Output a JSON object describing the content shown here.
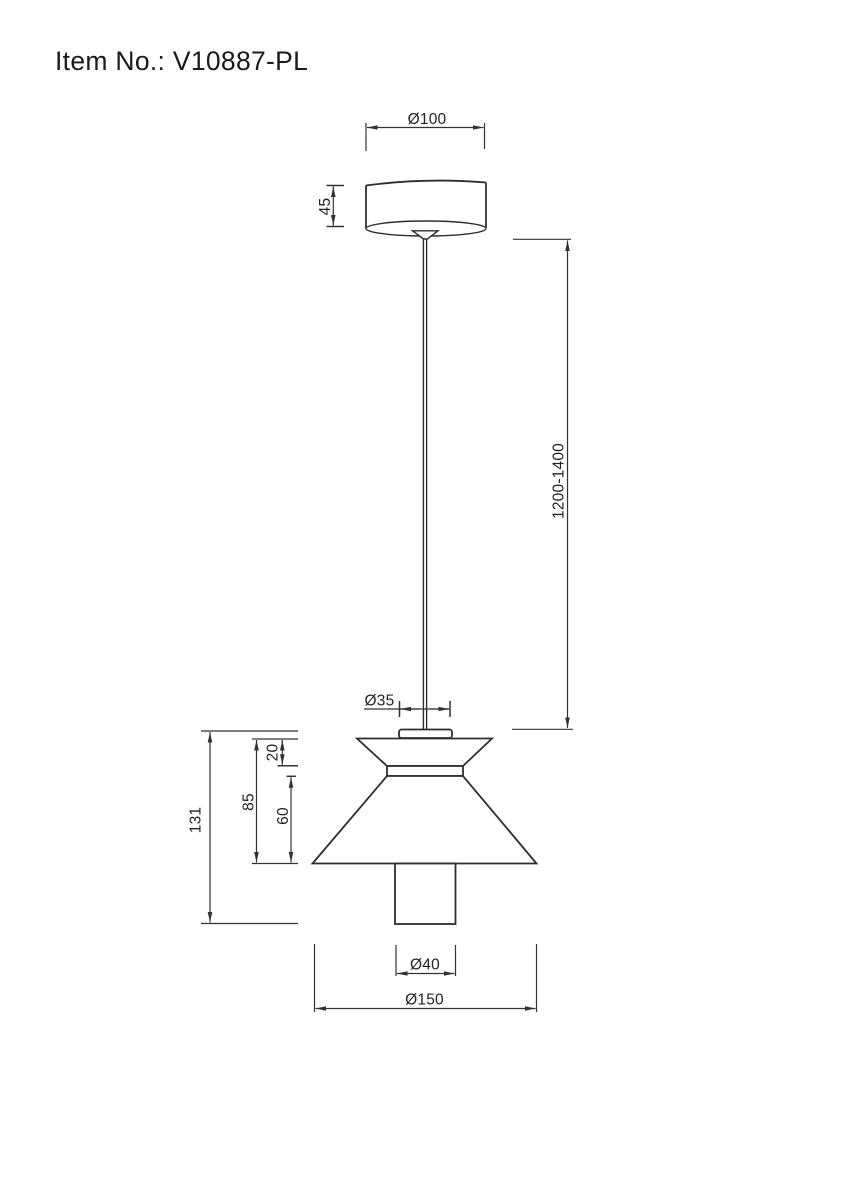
{
  "page": {
    "title": "Item No.: V10887-PL",
    "background": "#ffffff"
  },
  "drawing": {
    "type": "technical-line-drawing",
    "subject": "pendant lamp front elevation with dimensions",
    "units": "mm",
    "colors": {
      "object_line": "#2e2e2e",
      "dimension_line": "#333333",
      "text": "#232323"
    },
    "labels": {
      "canopy_diameter": "Ø100",
      "canopy_height": "45",
      "suspension_length": "1200-1400",
      "holder_diameter": "Ø35",
      "upper_cone_height": "20",
      "body_height": "85",
      "lower_cone_height": "60",
      "fixture_height": "131",
      "tube_diameter": "Ø40",
      "shade_diameter": "Ø150"
    }
  }
}
